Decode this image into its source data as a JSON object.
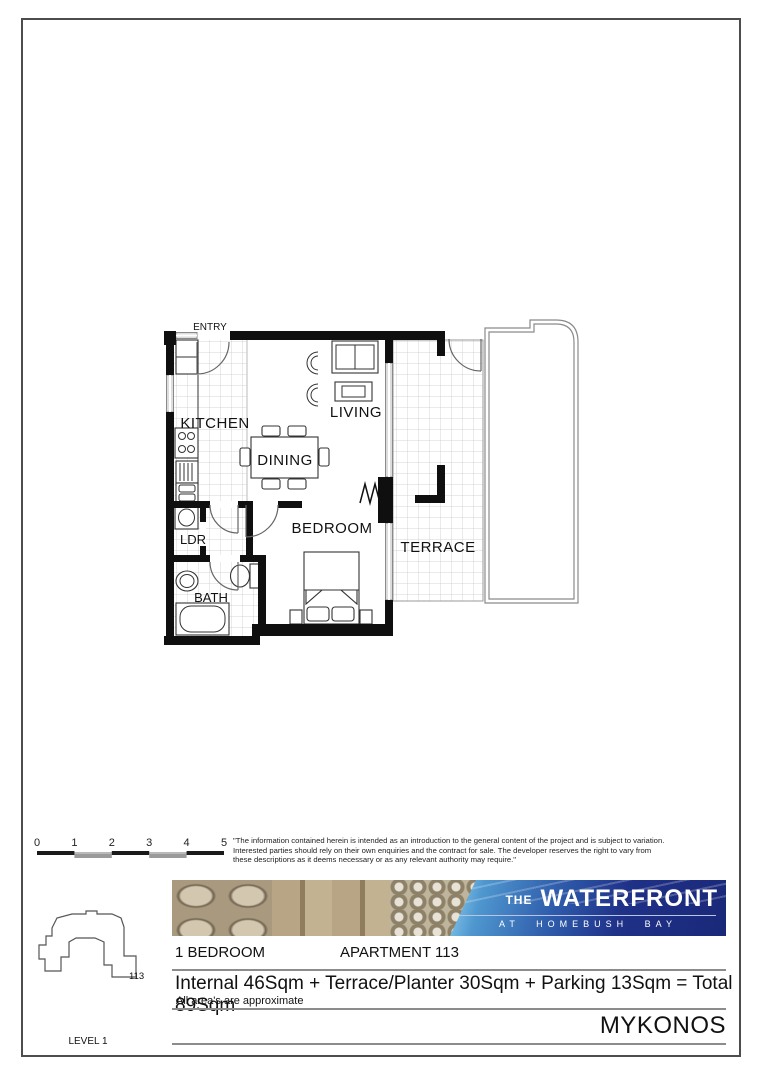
{
  "floor_plan": {
    "labels": {
      "entry": "ENTRY",
      "kitchen": "KITCHEN",
      "living": "LIVING",
      "dining": "DINING",
      "bedroom": "BEDROOM",
      "terrace": "TERRACE",
      "ldr": "LDR",
      "bath": "BATH"
    }
  },
  "scale_bar": {
    "ticks": [
      "0",
      "1",
      "2",
      "3",
      "4",
      "5"
    ]
  },
  "disclaimer": {
    "text": "\"The information contained herein is intended as an introduction to the general content of the project and is subject to variation. Interested parties should rely on their own enquiries and the contract for sale.  The developer reserves the right to vary from these descriptions as it deems necessary or as any relevant authority may require.\""
  },
  "brand": {
    "prefix": "THE",
    "name": "WATERFRONT",
    "tagline": "AT HOMEBUSH BAY",
    "colors": {
      "panel_dark": "#1a2878",
      "panel_mid": "#2f5cab",
      "panel_light": "#8fd0f0"
    }
  },
  "info": {
    "bedrooms": "1 BEDROOM",
    "apartment": "APARTMENT 113",
    "areas": "Internal 46Sqm + Terrace/Planter 30Sqm + Parking 13Sqm = Total 89Sqm",
    "approx_note": "All area's are approximate",
    "building_name": "MYKONOS"
  },
  "key_plan": {
    "unit_number": "113",
    "level": "LEVEL 1"
  }
}
